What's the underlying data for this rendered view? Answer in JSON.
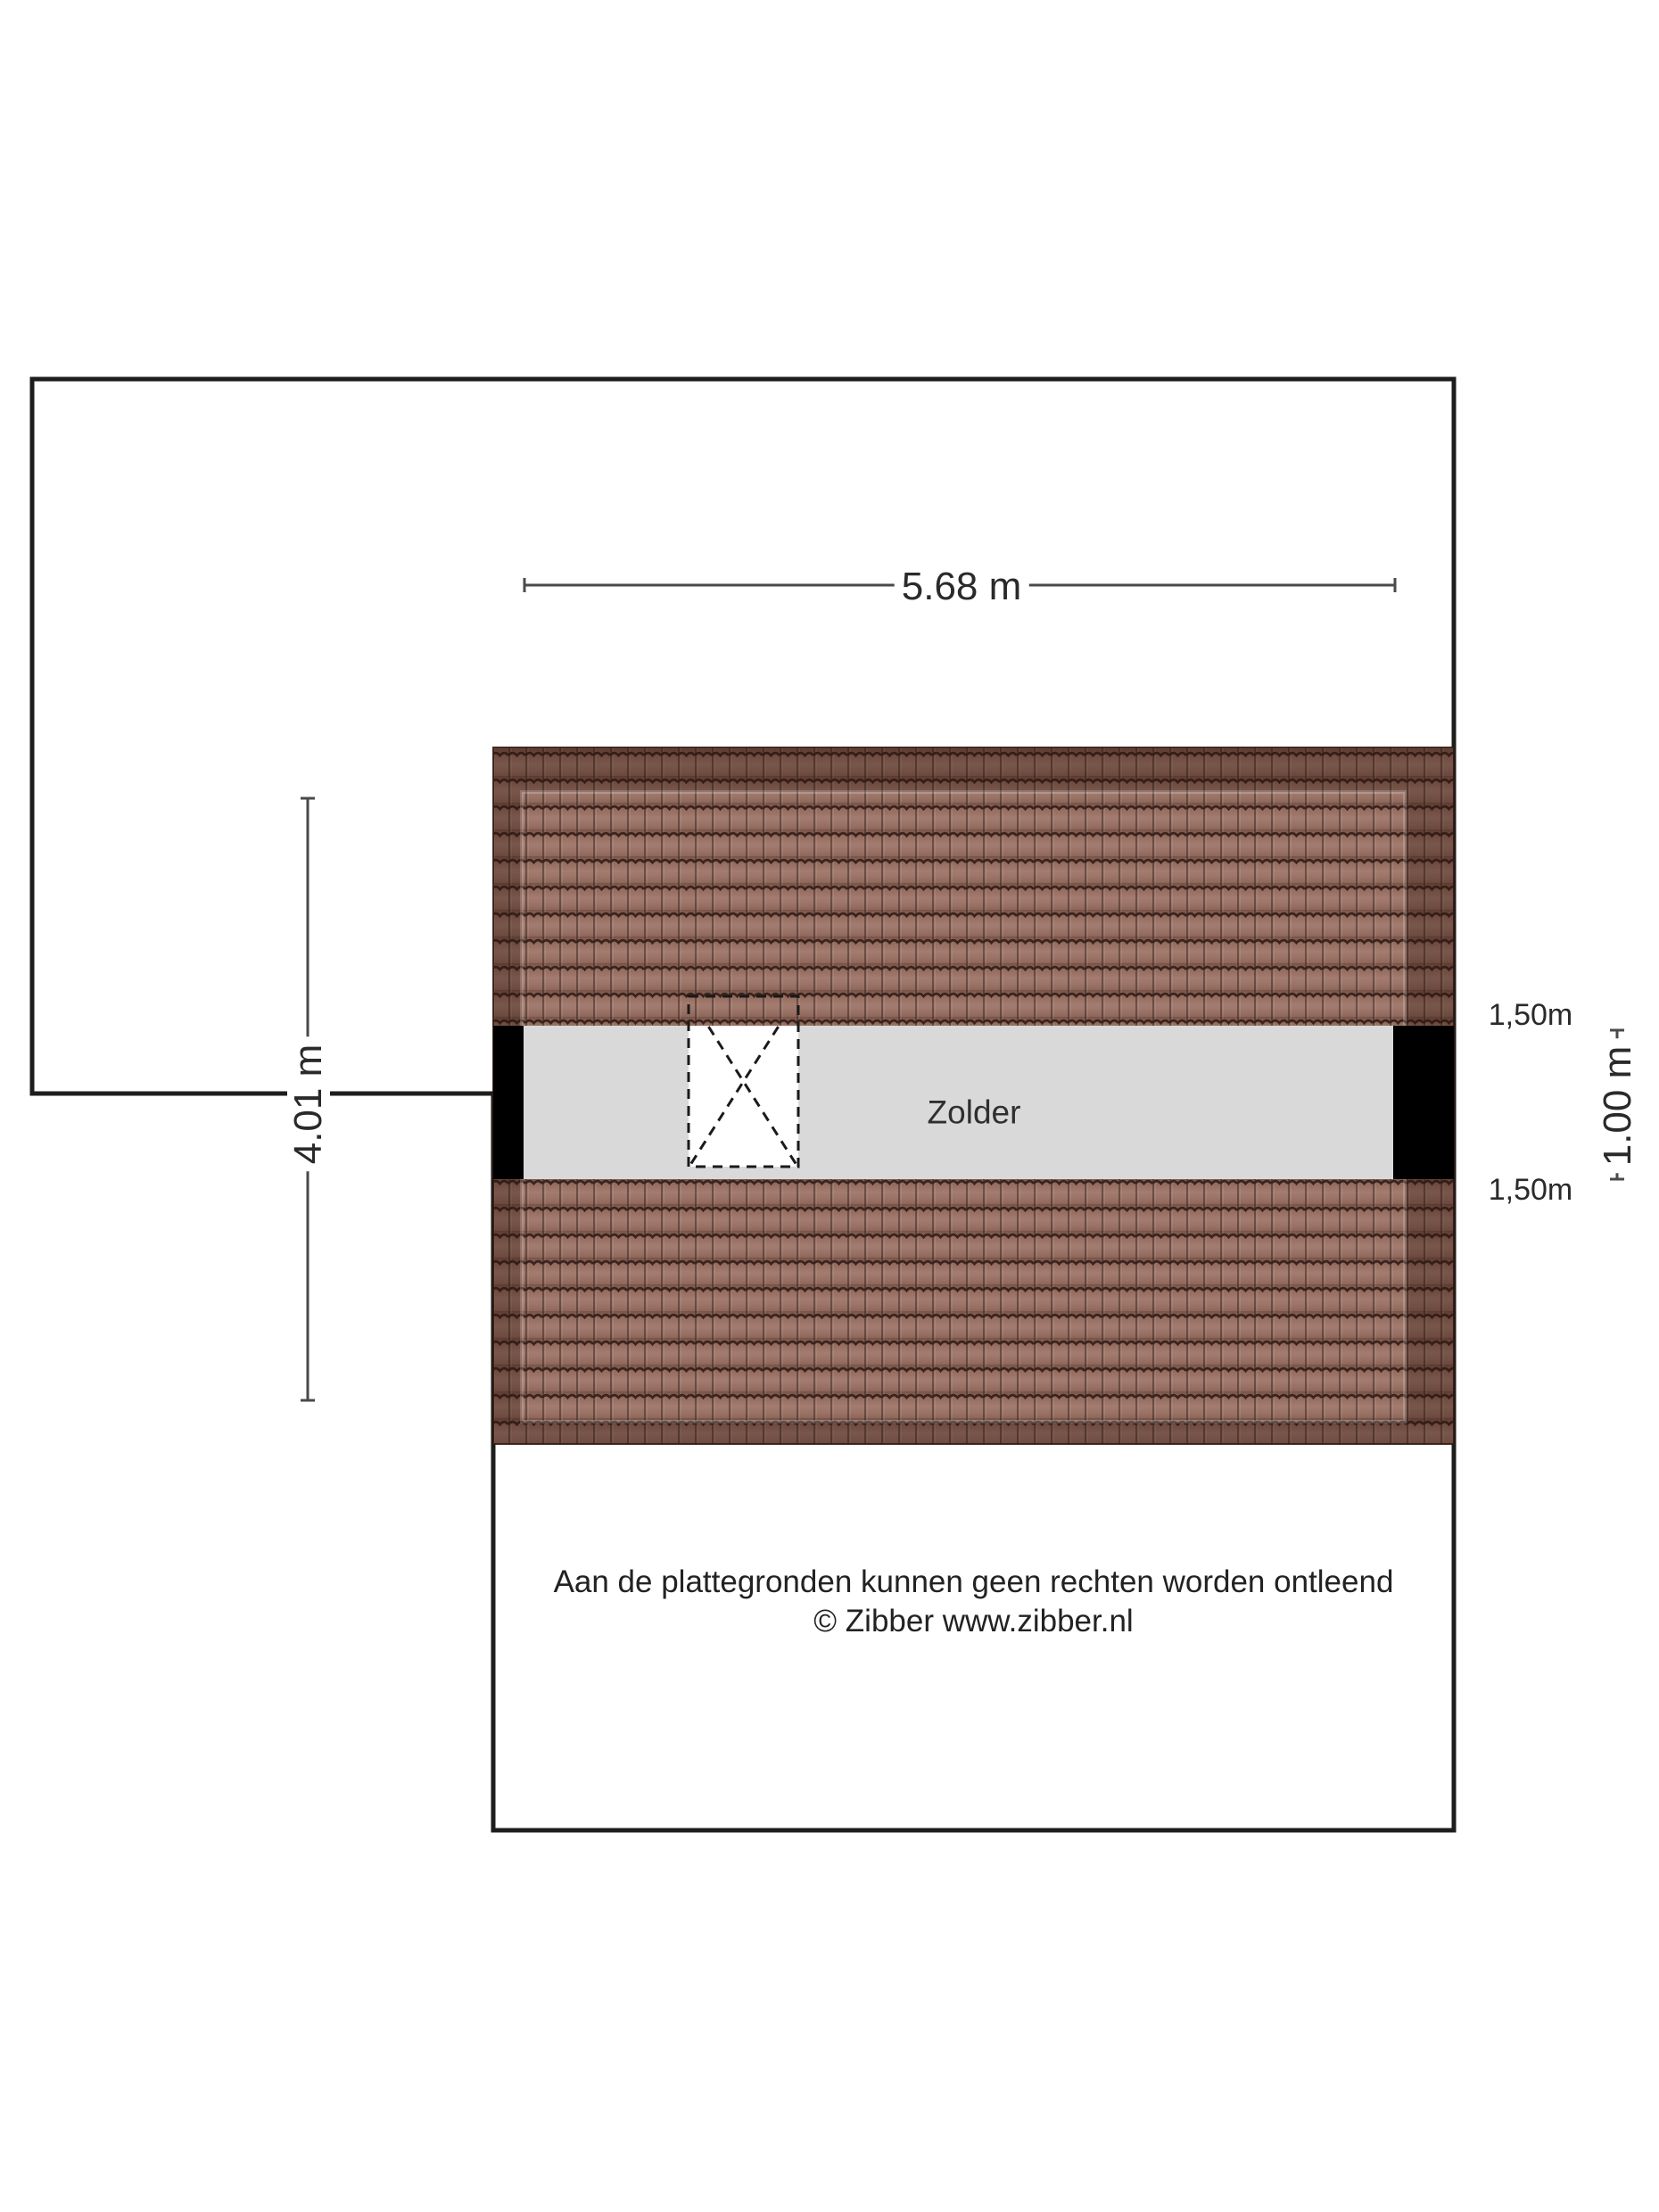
{
  "colors": {
    "outline": "#1d1d1b",
    "dim_line": "#4a4a4a",
    "text_color": "#2a2a2a",
    "room_fill": "#d9d9d9",
    "wall_fill": "#000000",
    "roof_base": "#9c7264",
    "roof_line": "#3a241d",
    "roof_shade": "rgba(43,20,12,0.36)",
    "void_dash": "#1a1a1a",
    "page_bg": "#ffffff"
  },
  "plan": {
    "room_label": "Zolder",
    "dimensions": {
      "width": "5.68 m",
      "depth": "4.01 m",
      "right_top": "1,50m",
      "right_height": "1.00 m",
      "right_bottom": "1,50m"
    }
  },
  "footer": {
    "disclaimer": "Aan de plattegronden kunnen geen rechten worden ontleend",
    "copyright": "© Zibber www.zibber.nl"
  }
}
